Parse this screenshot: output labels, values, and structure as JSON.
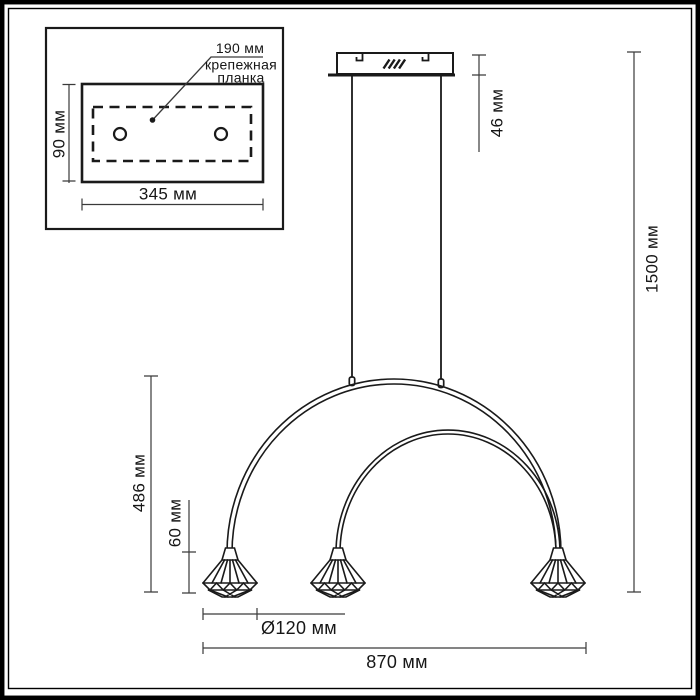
{
  "labels": {
    "inset": {
      "hole_spacing": "190 мм",
      "plate_name": [
        "крепежная",
        "планка"
      ],
      "plate_height": "90 мм",
      "plate_width": "345 мм"
    },
    "dims": {
      "canopy_height": "46 мм",
      "overall_height": "1500 мм",
      "arc_height": "486 мм",
      "shade_height": "60 мм",
      "shade_diameter": "Ø120 мм",
      "overall_width": "870 мм"
    }
  },
  "colors": {
    "line": "#1a1a1a",
    "dim_line": "#3a3a3a",
    "background": "#ffffff"
  }
}
